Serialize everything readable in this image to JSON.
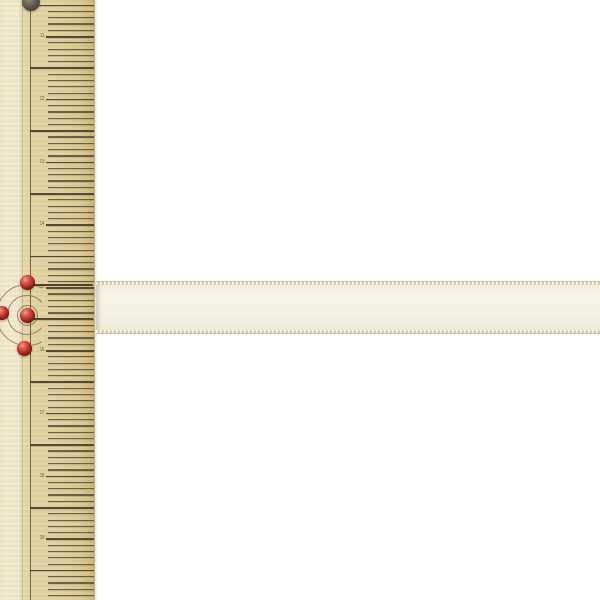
{
  "scene": {
    "description": "Product photo: wooden ruler with red marking pins measuring an ivory satin ribbon on white background",
    "background_color": "#fefefe"
  },
  "ruler": {
    "name": "wooden-ruler",
    "body_color": "#e2d2a2",
    "bevel_color": "#f1e9cc",
    "tick_color": "#564832",
    "edge_line_color": "#605030",
    "first_tick_y": 4.6,
    "tick_step_px": 6.28,
    "long_tick_every": 5,
    "tick_labels": [
      "11",
      "12",
      "13",
      "14",
      "15",
      "16",
      "17",
      "18",
      "19",
      "20"
    ]
  },
  "ribbon": {
    "name": "ivory-satin-ribbon",
    "main_color": "#f3f2e4",
    "edge_band_color": "#d2cba3",
    "left_x": 96,
    "top_y": 281,
    "height": 53
  },
  "pins": {
    "head_color": "#c63a33",
    "dark_pin": {
      "x": 31,
      "y": 2,
      "r": 9
    },
    "items": [
      {
        "x": 27,
        "y": 282,
        "r": 7.5
      },
      {
        "x": 2,
        "y": 313,
        "r": 7
      },
      {
        "x": 27,
        "y": 315,
        "r": 7.5
      },
      {
        "x": 24.5,
        "y": 348,
        "r": 7.5
      }
    ],
    "needles": [
      {
        "x1": 32,
        "y": 284,
        "x2": 93
      },
      {
        "x1": 32,
        "y": 317.5,
        "x2": 93
      }
    ]
  },
  "arcs": {
    "center_x": 27,
    "center_y": 315,
    "radii": [
      10.5,
      20,
      31
    ],
    "color": "rgba(125,104,66,0.75)"
  }
}
